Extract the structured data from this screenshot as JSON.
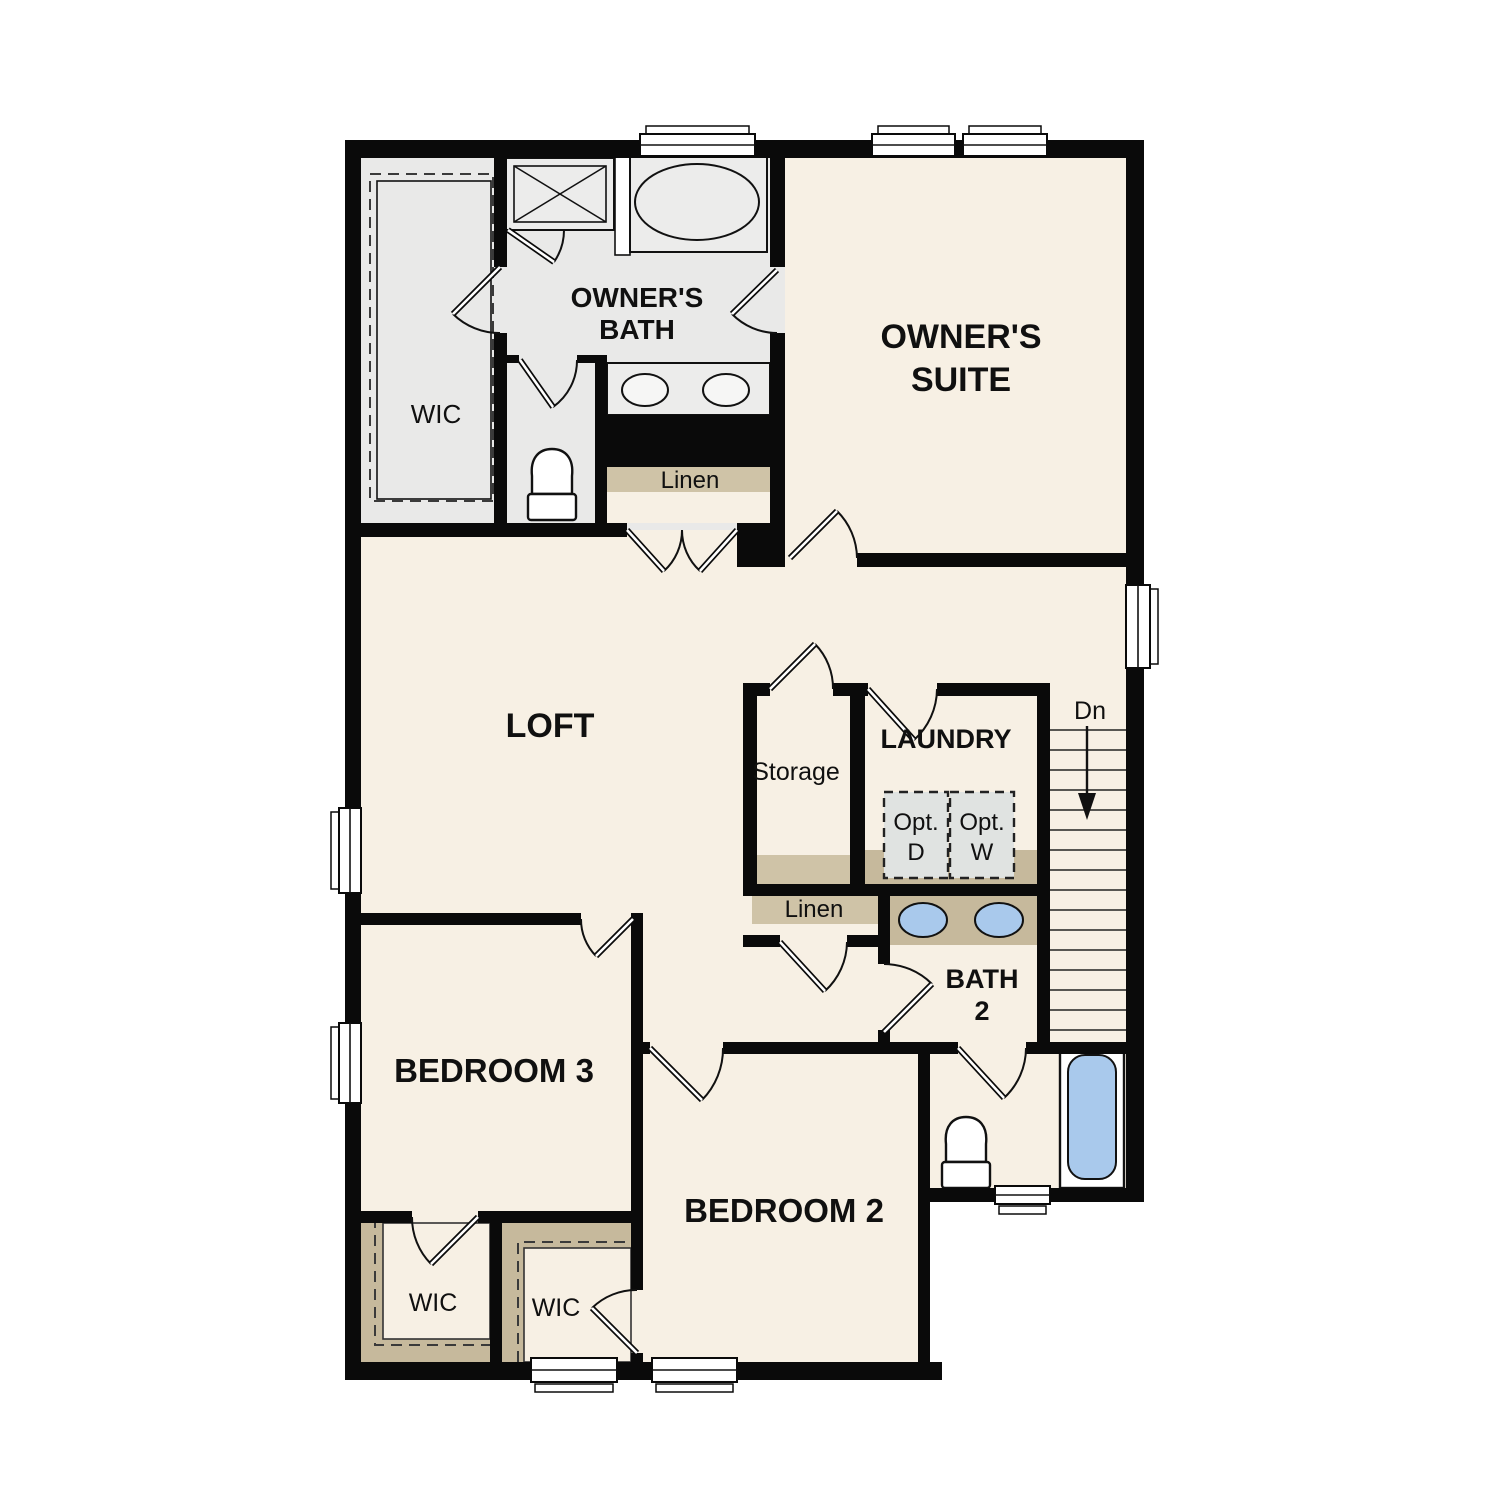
{
  "colors": {
    "wall": "#0a0a0a",
    "floor_cream": "#f7f0e4",
    "bath_floor_gray": "#e9e9e8",
    "shelf_tan": "#cfc3a7",
    "counter_tan": "#c6b99c",
    "fixture_blue": "#a9c9ec",
    "optional_appliance_gray": "#e0e3e1",
    "window_white": "#ffffff"
  },
  "labels": {
    "owners_bath_line1": "OWNER'S",
    "owners_bath_line2": "BATH",
    "owners_suite_line1": "OWNER'S",
    "owners_suite_line2": "SUITE",
    "wic_owners": "WIC",
    "linen_upper": "Linen",
    "loft": "LOFT",
    "storage": "Storage",
    "laundry": "LAUNDRY",
    "opt_dryer_line1": "Opt.",
    "opt_dryer_line2": "D",
    "opt_washer_line1": "Opt.",
    "opt_washer_line2": "W",
    "stairs_down": "Dn",
    "linen_lower": "Linen",
    "bath2_line1": "BATH",
    "bath2_line2": "2",
    "bedroom3": "BEDROOM 3",
    "bedroom2": "BEDROOM 2",
    "wic_bedroom3": "WIC",
    "wic_bedroom2": "WIC"
  }
}
